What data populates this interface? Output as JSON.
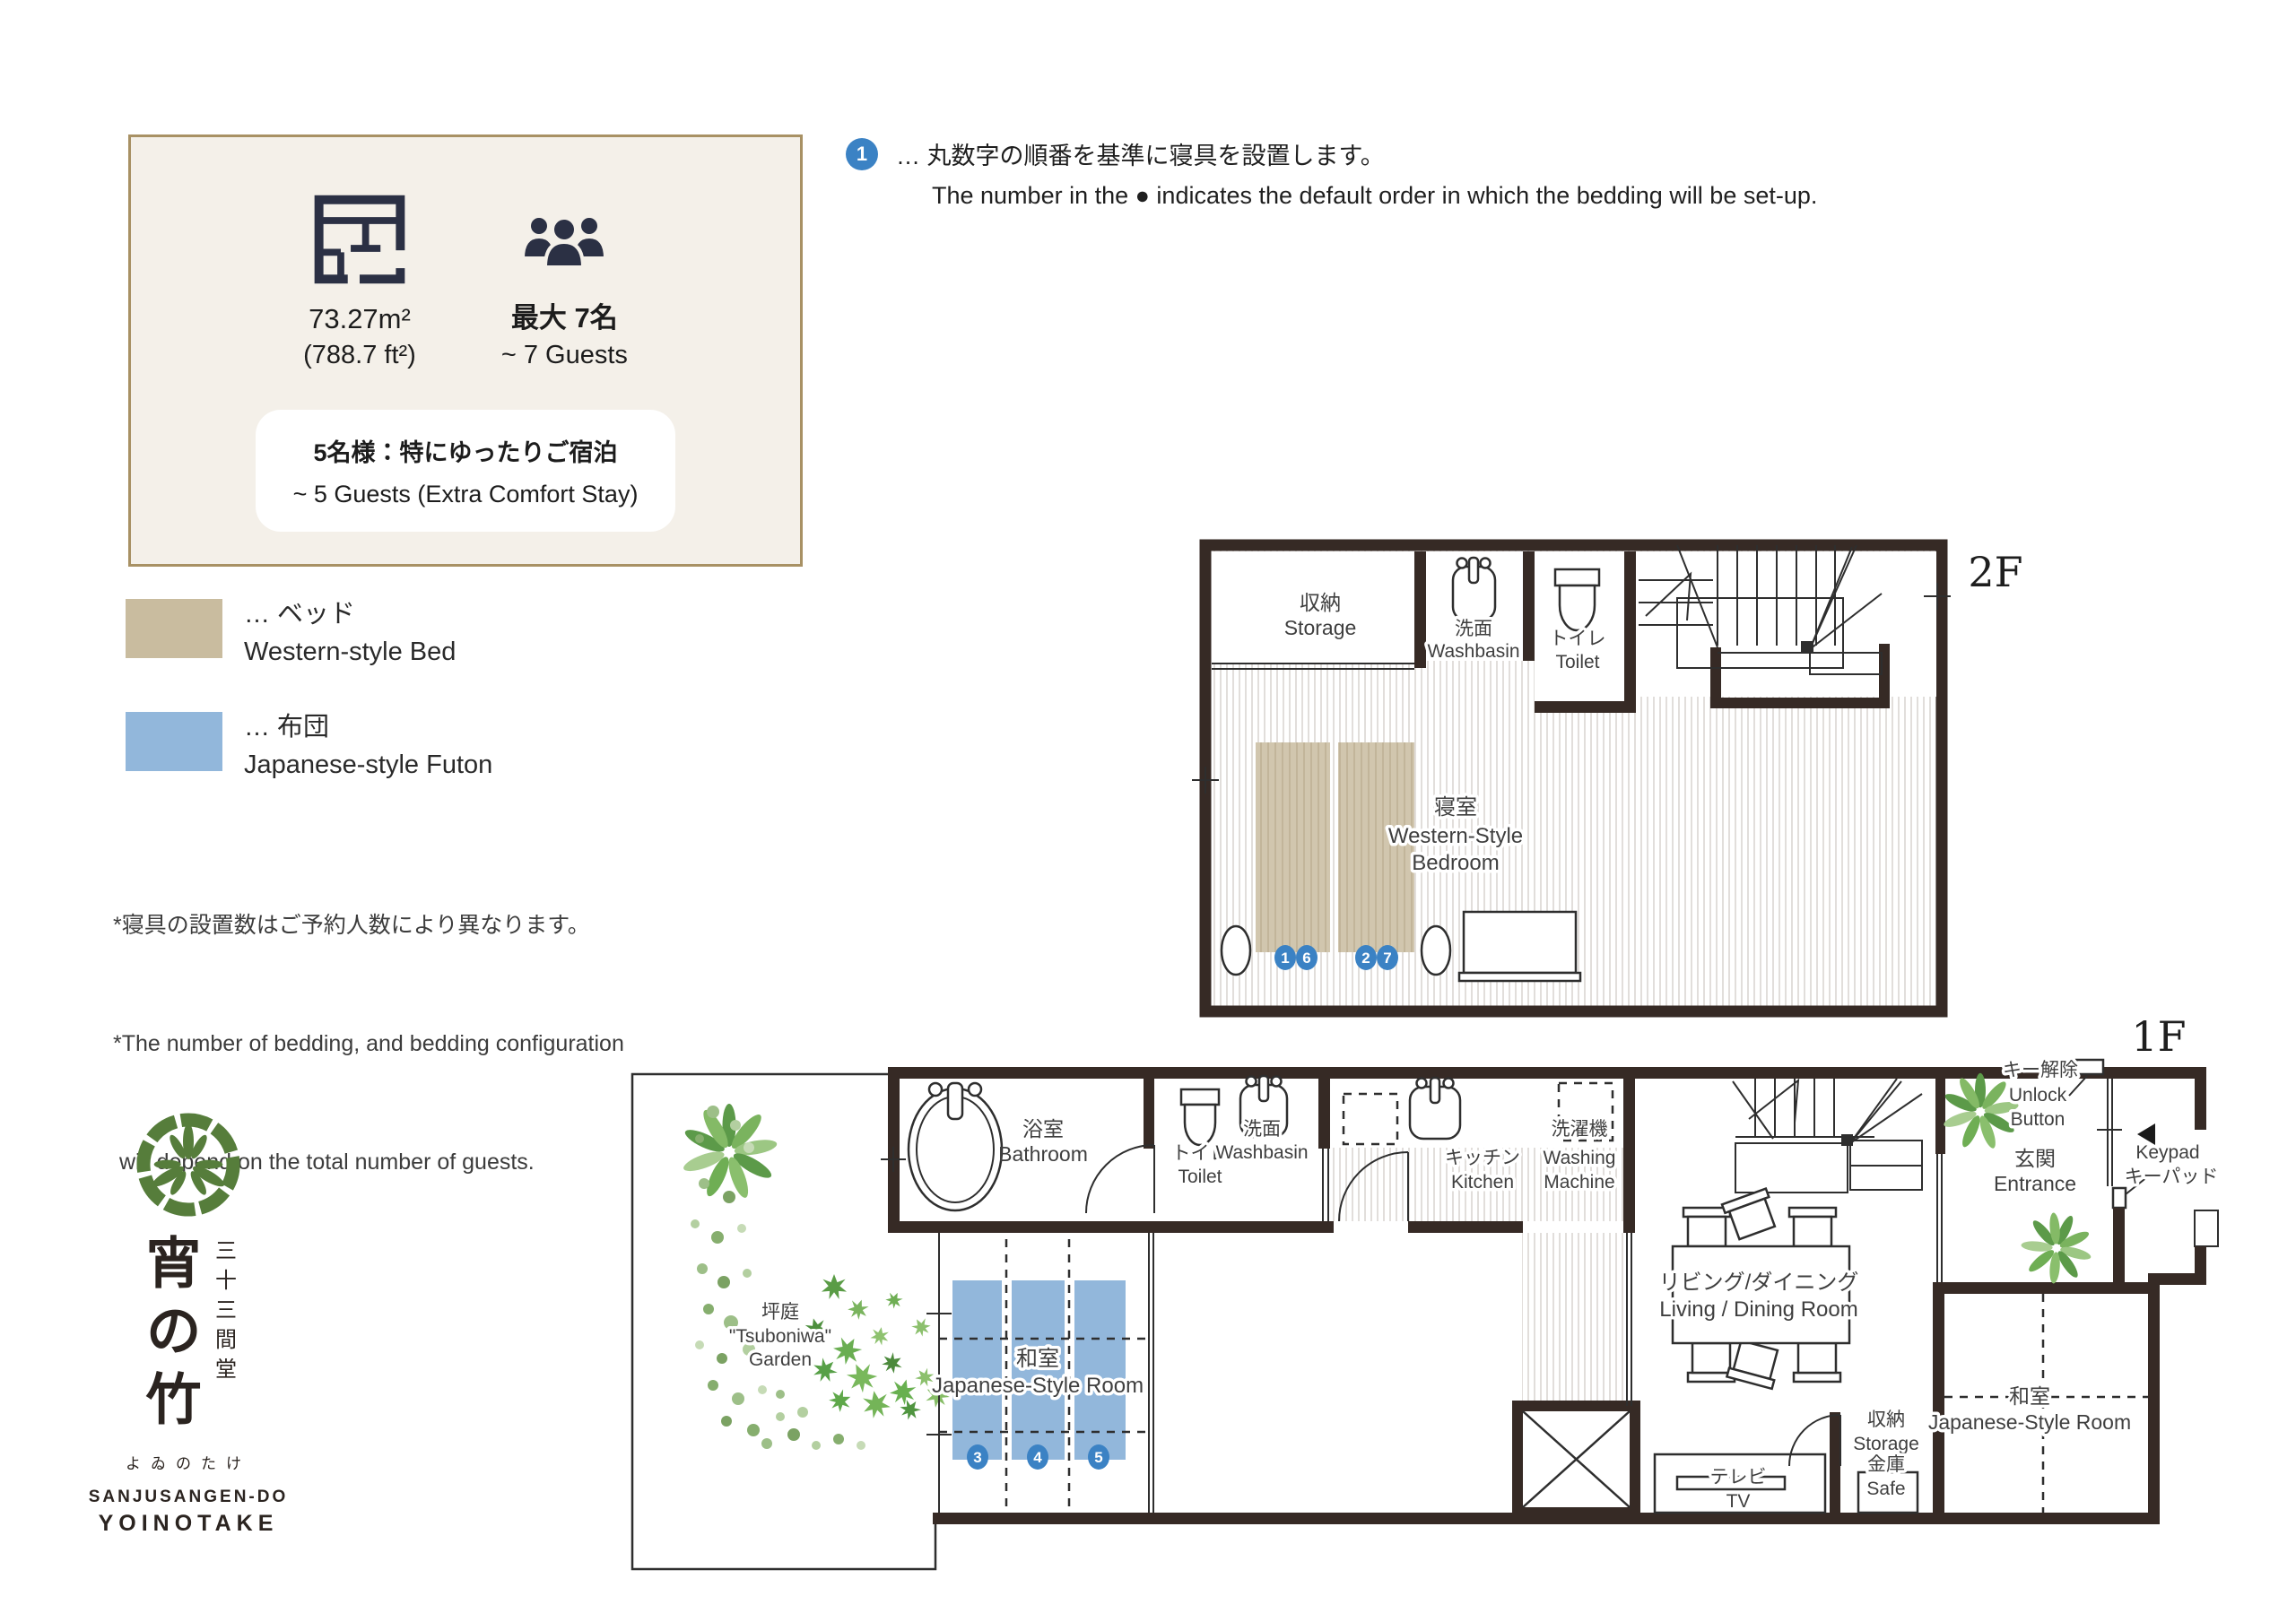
{
  "info_box": {
    "area_m2": "73.27m²",
    "area_ft2": "(788.7 ft²)",
    "capacity_jp": "最大 7名",
    "capacity_en": "~ 7 Guests",
    "comfort_jp": "5名様：特にゆったりご宿泊",
    "comfort_en": "~ 5 Guests (Extra Comfort Stay)"
  },
  "bedding_note": {
    "badge": "1",
    "jp": "… 丸数字の順番を基準に寝具を設置します。",
    "en": "The number in the ● indicates the default order in which the bedding will be set-up."
  },
  "legend": {
    "bed_jp": "… ベッド",
    "bed_en": "Western-style Bed",
    "bed_color": "#c9bc9f",
    "futon_jp": "… 布団",
    "futon_en": "Japanese-style Futon",
    "futon_color": "#92b7db"
  },
  "notes": {
    "line1": "*寝具の設置数はご予約人数により異なります。",
    "line2": "*The number of bedding, and bedding configuration",
    "line3": " will depend on the total number of guests."
  },
  "logo": {
    "vertical_title": "三十三間堂",
    "main_chars": "宵の竹",
    "kana": "よゐのたけ",
    "en_line1": "SANJUSANGEN-DO",
    "en_line2": "YOINOTAKE"
  },
  "floor2": {
    "floor_label": "2F",
    "storage_jp": "収納",
    "storage_en": "Storage",
    "washbasin_jp": "洗面",
    "washbasin_en": "Washbasin",
    "toilet_jp": "トイレ",
    "toilet_en": "Toilet",
    "bedroom_jp": "寝室",
    "bedroom_en1": "Western-Style",
    "bedroom_en2": "Bedroom",
    "beds": {
      "b1": "1",
      "b2": "6",
      "b3": "2",
      "b4": "7"
    }
  },
  "floor1": {
    "floor_label": "1F",
    "bathroom_jp": "浴室",
    "bathroom_en": "Bathroom",
    "toilet_jp": "トイレ",
    "toilet_en": "Toilet",
    "washbasin_jp": "洗面",
    "washbasin_en": "Washbasin",
    "kitchen_jp": "キッチン",
    "kitchen_en": "Kitchen",
    "washer_jp": "洗濯機",
    "washer_en1": "Washing",
    "washer_en2": "Machine",
    "jroom_jp": "和室",
    "jroom_en": "Japanese-Style Room",
    "living_jp": "リビング/ダイニング",
    "living_en": "Living / Dining Room",
    "tv_jp": "テレビ",
    "tv_en": "TV",
    "storage_jp": "収納",
    "storage_en": "Storage",
    "safe_jp": "金庫",
    "safe_en": "Safe",
    "entrance_jp": "玄関",
    "entrance_en": "Entrance",
    "unlock_jp": "キー解除",
    "unlock_en1": "Unlock",
    "unlock_en2": "Button",
    "keypad_en": "Keypad",
    "keypad_jp": "キーパッド",
    "garden_jp": "坪庭",
    "garden_en1": "\"Tsuboniwa\"",
    "garden_en2": "Garden",
    "jroom2_jp": "和室",
    "jroom2_en": "Japanese-Style Room",
    "futons": {
      "f3": "3",
      "f4": "4",
      "f5": "5"
    }
  },
  "colors": {
    "wall": "#362a25",
    "bed": "#cfc3aa",
    "futon": "#92b7db",
    "number_badge": "#3b82c4",
    "info_box_bg": "#f4f0e9",
    "info_box_border": "#a89164",
    "floor_stripe": "#dad6d2",
    "crest_green": "#567d3b"
  }
}
